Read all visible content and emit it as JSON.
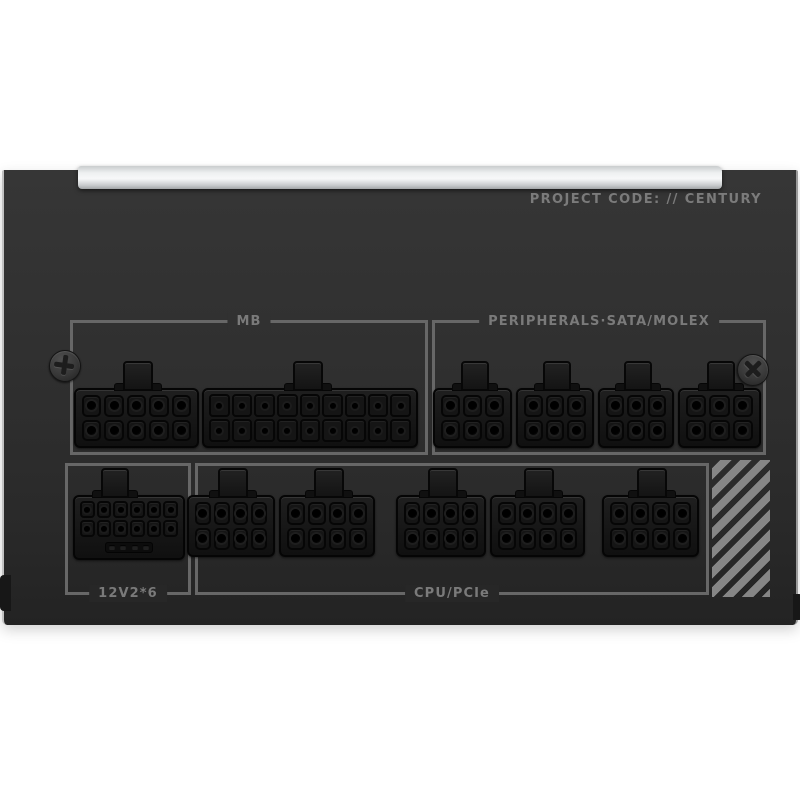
{
  "psu": {
    "project_code": "PROJECT CODE: // CENTURY",
    "sections": {
      "mb": {
        "label": "MB"
      },
      "peripherals": {
        "label": "PERIPHERALS·SATA/MOLEX"
      },
      "v12": {
        "label": "12V2*6"
      },
      "cpu": {
        "label": "CPU/PCIe"
      }
    },
    "connectors": [
      {
        "id": "mb-a",
        "section": "mb",
        "pins": 10,
        "cols": 5,
        "rows": 2
      },
      {
        "id": "mb-b",
        "section": "mb",
        "pins": 18,
        "cols": 9,
        "rows": 2
      },
      {
        "id": "peri-1",
        "section": "peripherals",
        "pins": 6,
        "cols": 3,
        "rows": 2
      },
      {
        "id": "peri-2",
        "section": "peripherals",
        "pins": 6,
        "cols": 3,
        "rows": 2
      },
      {
        "id": "peri-3",
        "section": "peripherals",
        "pins": 6,
        "cols": 3,
        "rows": 2
      },
      {
        "id": "peri-4",
        "section": "peripherals",
        "pins": 6,
        "cols": 3,
        "rows": 2
      },
      {
        "id": "v12",
        "section": "v12",
        "pins": 12,
        "cols": 6,
        "rows": 2,
        "sense_pins": 4
      },
      {
        "id": "cpu-1",
        "section": "cpu",
        "pins": 8,
        "cols": 4,
        "rows": 2
      },
      {
        "id": "cpu-2",
        "section": "cpu",
        "pins": 8,
        "cols": 4,
        "rows": 2
      },
      {
        "id": "cpu-3",
        "section": "cpu",
        "pins": 8,
        "cols": 4,
        "rows": 2
      },
      {
        "id": "cpu-4",
        "section": "cpu",
        "pins": 8,
        "cols": 4,
        "rows": 2
      },
      {
        "id": "cpu-5",
        "section": "cpu",
        "pins": 8,
        "cols": 4,
        "rows": 2
      }
    ],
    "screws": [
      {
        "id": "left"
      },
      {
        "id": "right"
      }
    ],
    "colors": {
      "panel": "#2e2e2e",
      "bracket_line": "#676767",
      "label_text": "#7a7a7a",
      "project_text": "#7b7b7b",
      "silver_bar": "#e9ebec",
      "connector_body": "#161616",
      "stripe": "#868686",
      "background": "#ffffff"
    }
  }
}
